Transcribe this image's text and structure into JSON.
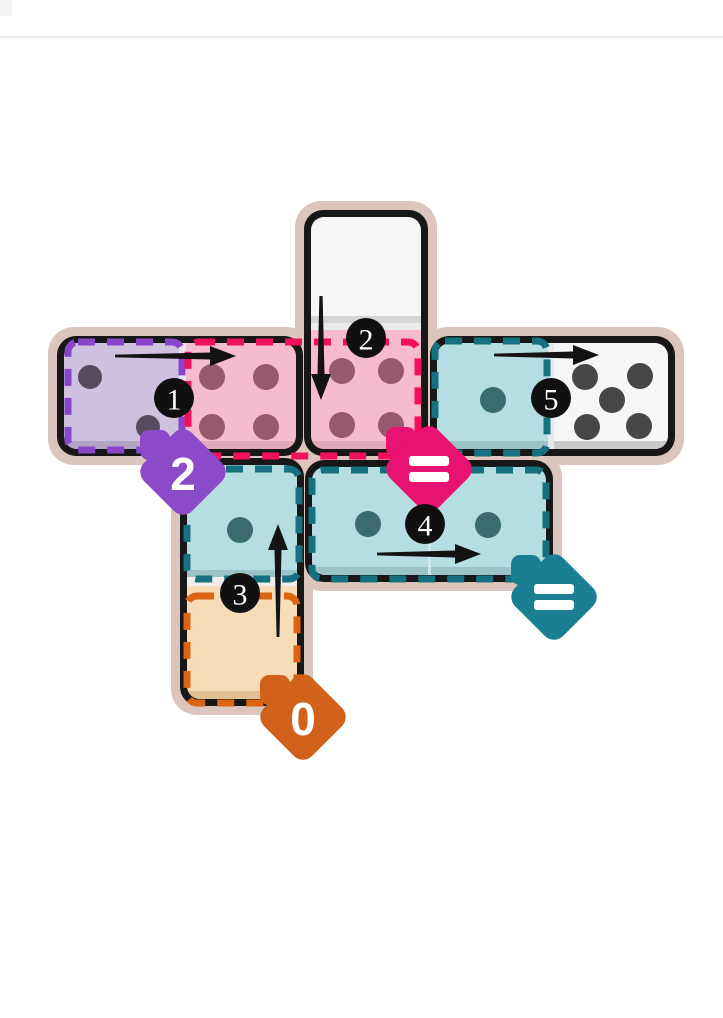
{
  "page": {
    "background": "#ffffff",
    "divider_color": "#e8e8e8"
  },
  "board": {
    "frame_color": "#dcc5bc",
    "tile_border_color": "#171717",
    "dominoes": [
      {
        "id": "left-horizontal",
        "orientation": "horizontal",
        "cells": [
          {
            "pips": 2,
            "highlight": "purple"
          },
          {
            "pips": 4,
            "highlight": "pink"
          }
        ]
      },
      {
        "id": "top-vertical",
        "orientation": "vertical",
        "cells": [
          {
            "pips": 0,
            "highlight": "none"
          },
          {
            "pips": 4,
            "highlight": "pink"
          }
        ]
      },
      {
        "id": "right-horizontal",
        "orientation": "horizontal",
        "cells": [
          {
            "pips": 1,
            "highlight": "teal"
          },
          {
            "pips": 5,
            "highlight": "none"
          }
        ]
      },
      {
        "id": "middle-horizontal",
        "orientation": "horizontal",
        "cells": [
          {
            "pips": 1,
            "highlight": "teal"
          },
          {
            "pips": 1,
            "highlight": "teal"
          }
        ]
      },
      {
        "id": "bottom-vertical",
        "orientation": "vertical",
        "cells": [
          {
            "pips": 1,
            "highlight": "teal"
          },
          {
            "pips": 0,
            "highlight": "orange"
          }
        ]
      }
    ],
    "steps": [
      {
        "number": "1",
        "arrow": "right"
      },
      {
        "number": "2",
        "arrow": "down"
      },
      {
        "number": "3",
        "arrow": "up"
      },
      {
        "number": "4",
        "arrow": "right"
      },
      {
        "number": "5",
        "arrow": "right"
      }
    ],
    "badges": [
      {
        "label": "2",
        "color": "#8b4bc9"
      },
      {
        "label": "=",
        "color": "#e81272"
      },
      {
        "label": "=",
        "color": "#1b7f93"
      },
      {
        "label": "0",
        "color": "#d2611b"
      }
    ],
    "highlight_colors": {
      "purple": "#8a46c9",
      "pink": "#f2105c",
      "teal": "#17707f",
      "orange": "#dd6412"
    }
  }
}
